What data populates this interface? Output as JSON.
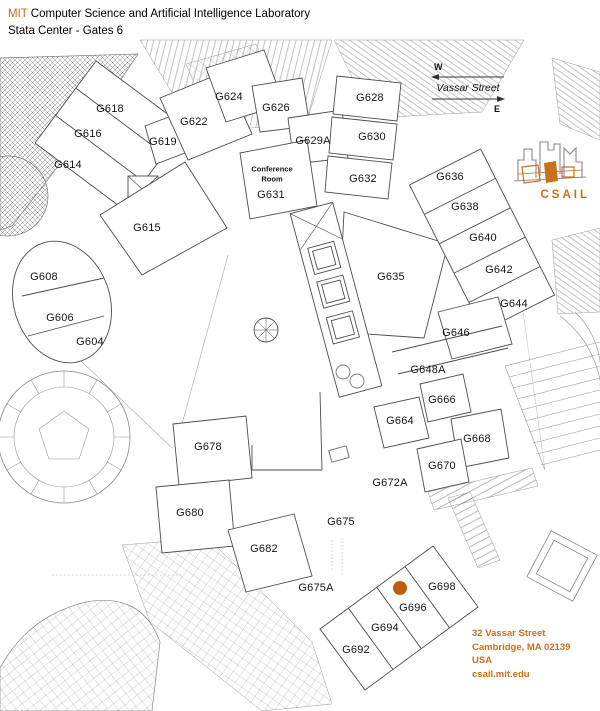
{
  "header": {
    "brand": "MIT",
    "title_rest": " Computer Science and Artificial Intelligence Laboratory",
    "subtitle": "Stata Center - Gates 6"
  },
  "compass": {
    "west_label": "W",
    "east_label": "E",
    "street_label": "Vassar Street"
  },
  "logo": {
    "wordmark": "CSAIL"
  },
  "address": {
    "lines": [
      "32 Vassar Street",
      "Cambridge, MA 02139",
      "USA",
      "csail.mit.edu"
    ]
  },
  "colors": {
    "accent_orange": "#c8701a",
    "marker_orange": "#c05e0b",
    "wall_gray": "#4d4d4d",
    "detail_gray": "#999999"
  },
  "marker": {
    "room": "G696",
    "x": 400,
    "y": 588,
    "radius": 7
  },
  "area_labels": [
    {
      "text": "Conference",
      "x": 272,
      "y": 169
    },
    {
      "text": "Room",
      "x": 272,
      "y": 179
    }
  ],
  "rooms": [
    {
      "label": "G604",
      "x": 90,
      "y": 342
    },
    {
      "label": "G606",
      "x": 60,
      "y": 318
    },
    {
      "label": "G608",
      "x": 44,
      "y": 277
    },
    {
      "label": "G614",
      "x": 68,
      "y": 165
    },
    {
      "label": "G615",
      "x": 147,
      "y": 228
    },
    {
      "label": "G616",
      "x": 88,
      "y": 134
    },
    {
      "label": "G618",
      "x": 110,
      "y": 109
    },
    {
      "label": "G619",
      "x": 163,
      "y": 142
    },
    {
      "label": "G622",
      "x": 194,
      "y": 122
    },
    {
      "label": "G624",
      "x": 229,
      "y": 97
    },
    {
      "label": "G626",
      "x": 276,
      "y": 108
    },
    {
      "label": "G628",
      "x": 370,
      "y": 98
    },
    {
      "label": "G629A",
      "x": 313,
      "y": 141
    },
    {
      "label": "G630",
      "x": 372,
      "y": 137
    },
    {
      "label": "G631",
      "x": 271,
      "y": 195
    },
    {
      "label": "G632",
      "x": 363,
      "y": 179
    },
    {
      "label": "G635",
      "x": 391,
      "y": 277
    },
    {
      "label": "G636",
      "x": 450,
      "y": 177
    },
    {
      "label": "G638",
      "x": 465,
      "y": 207
    },
    {
      "label": "G640",
      "x": 483,
      "y": 238
    },
    {
      "label": "G642",
      "x": 499,
      "y": 270
    },
    {
      "label": "G644",
      "x": 514,
      "y": 304
    },
    {
      "label": "G646",
      "x": 456,
      "y": 333
    },
    {
      "label": "G648A",
      "x": 428,
      "y": 370
    },
    {
      "label": "G664",
      "x": 400,
      "y": 421
    },
    {
      "label": "G666",
      "x": 442,
      "y": 400
    },
    {
      "label": "G668",
      "x": 477,
      "y": 439
    },
    {
      "label": "G670",
      "x": 442,
      "y": 466
    },
    {
      "label": "G672A",
      "x": 390,
      "y": 483
    },
    {
      "label": "G675",
      "x": 341,
      "y": 522
    },
    {
      "label": "G675A",
      "x": 316,
      "y": 588
    },
    {
      "label": "G678",
      "x": 208,
      "y": 447
    },
    {
      "label": "G680",
      "x": 190,
      "y": 513
    },
    {
      "label": "G682",
      "x": 264,
      "y": 549
    },
    {
      "label": "G692",
      "x": 356,
      "y": 650
    },
    {
      "label": "G694",
      "x": 385,
      "y": 628
    },
    {
      "label": "G696",
      "x": 413,
      "y": 608
    },
    {
      "label": "G698",
      "x": 442,
      "y": 587
    }
  ]
}
